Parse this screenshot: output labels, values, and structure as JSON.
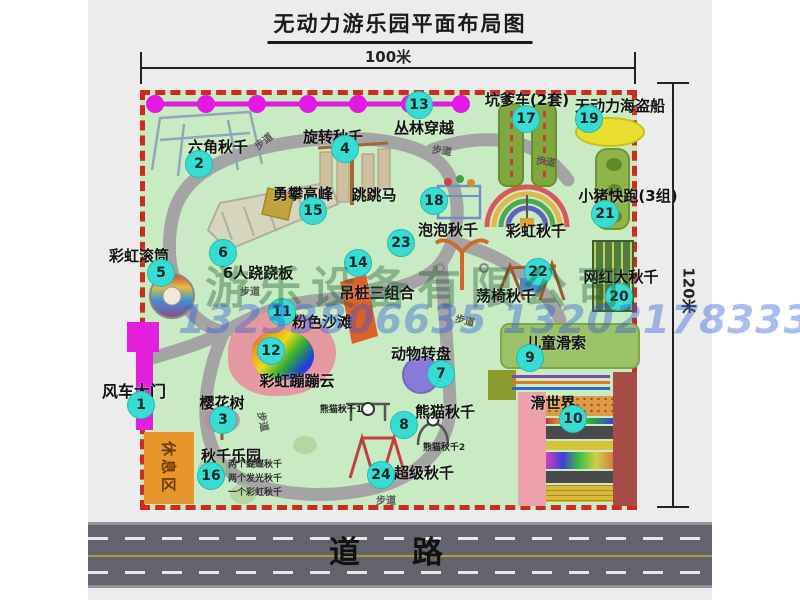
{
  "title": "无动力游乐园平面布局图",
  "dimensions": {
    "width_label": "100米",
    "height_label": "120米"
  },
  "road_label": "道路",
  "watermark": {
    "company": "游乐设备有限公司",
    "phones": "13233806635 13202178333"
  },
  "extras": {
    "rainbow_swing": "彩虹秋千",
    "panda1": "熊猫秋千1",
    "panda2": "熊猫秋千2",
    "rest_area": "休息区",
    "walkway": "步道"
  },
  "attractions": [
    {
      "num": "1",
      "name": "风车大门"
    },
    {
      "num": "2",
      "name": "六角秋千"
    },
    {
      "num": "3",
      "name": "樱花树"
    },
    {
      "num": "4",
      "name": "旋转秋千"
    },
    {
      "num": "5",
      "name": "彩虹滚筒"
    },
    {
      "num": "6",
      "name": "6人跷跷板"
    },
    {
      "num": "7",
      "name": "动物转盘"
    },
    {
      "num": "8",
      "name": "熊猫秋千"
    },
    {
      "num": "9",
      "name": "儿童滑索"
    },
    {
      "num": "10",
      "name": "滑世界"
    },
    {
      "num": "11",
      "name": "粉色沙滩"
    },
    {
      "num": "12",
      "name": "彩虹蹦蹦云"
    },
    {
      "num": "13",
      "name": "丛林穿越"
    },
    {
      "num": "14",
      "name": "吊桩三组合"
    },
    {
      "num": "15",
      "name": "勇攀高峰"
    },
    {
      "num": "16",
      "name": "秋千乐园",
      "notes": [
        "两个蝴蝶秋千",
        "两个发光秋千",
        "一个彩虹秋千"
      ]
    },
    {
      "num": "17",
      "name": "坑爹车(2套)"
    },
    {
      "num": "18",
      "name": "跳跳马"
    },
    {
      "num": "19",
      "name": "无动力海盗船"
    },
    {
      "num": "20",
      "name": "网红大秋千"
    },
    {
      "num": "21",
      "name": "小猪快跑(3组)"
    },
    {
      "num": "22",
      "name": "荡椅秋千"
    },
    {
      "num": "23",
      "name": "泡泡秋千"
    },
    {
      "num": "24",
      "name": "超级秋千"
    }
  ],
  "colors": {
    "park_green": "#c9ebc4",
    "border_red": "#ce2a20",
    "marker_teal": "#38dcd2",
    "gate_magenta": "#e41fdc",
    "path_gray": "#a4a4a4",
    "road_gray": "#63636e",
    "rest_orange": "#e8962c"
  }
}
